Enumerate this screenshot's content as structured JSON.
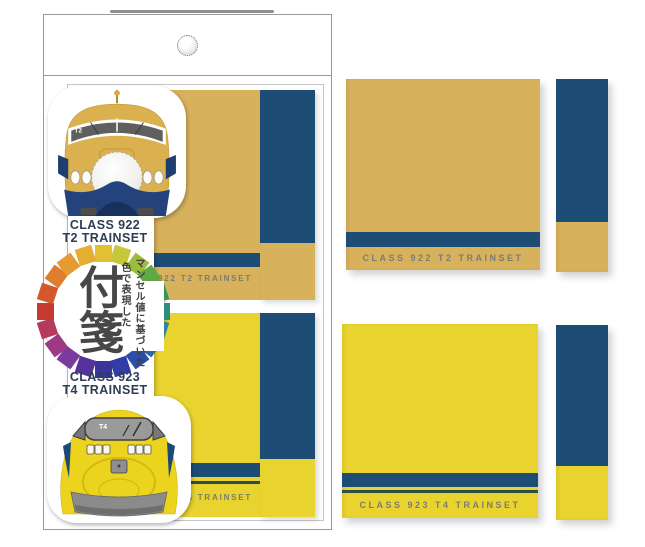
{
  "package": {
    "pad1_label": "CLASS 922 T2 TRAINSET",
    "pad2_label": "CLASS 923 T4 TRAINSET",
    "card": {
      "train1_class_line1": "CLASS 922",
      "train1_class_line2": "T2 TRAINSET",
      "train2_class_line1": "CLASS 923",
      "train2_class_line2": "T4 TRAINSET",
      "logo_title": "付箋",
      "logo_tagline_col1": "マンセル値に基づいた",
      "logo_tagline_col2": "色で表現した",
      "train_922_number": "T2",
      "train_923_number": "T4"
    }
  },
  "products": {
    "pad_922_label": "CLASS 922 T2 TRAINSET",
    "pad_923_label": "CLASS 923 T4 TRAINSET"
  },
  "colors": {
    "mustard": "#d7b15c",
    "yellow": "#e9d32e",
    "navy": "#1d4d75",
    "thin_line": "#2c4f45",
    "label_grey": "#7d7c6e",
    "train922_body": "#dbb04f",
    "train922_skirt": "#24437c",
    "train923_body": "#ecd31d",
    "windshield_grey": "#8f8f8f",
    "ring": [
      "#e3c032",
      "#c8c639",
      "#9cbc3c",
      "#5fa845",
      "#37945a",
      "#2f8f7c",
      "#2d86a0",
      "#2b66a8",
      "#2b4fa8",
      "#2f3da5",
      "#3b359b",
      "#55339b",
      "#7c3a9e",
      "#9c3a85",
      "#b53a5e",
      "#c53a2f",
      "#d4582c",
      "#df7d2e",
      "#e49b31",
      "#e4ae32"
    ]
  }
}
